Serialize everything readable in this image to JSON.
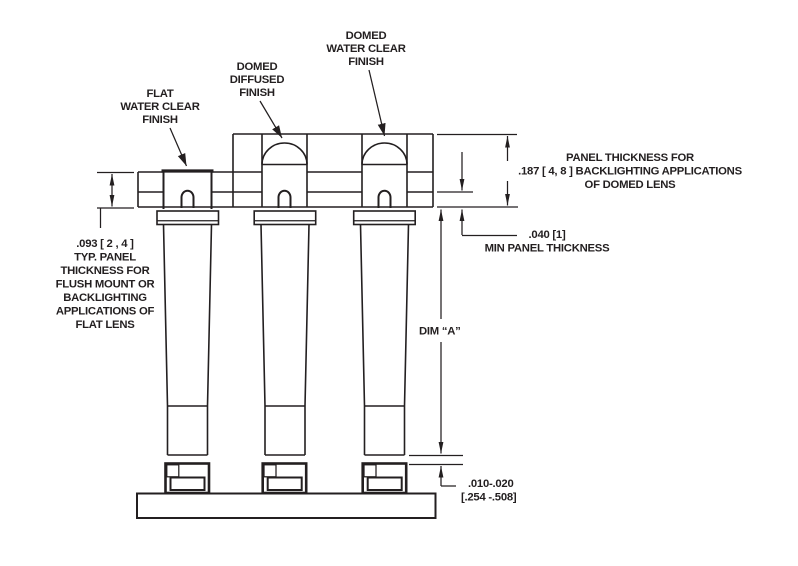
{
  "drawing_type": "panel-mount LED light pipe cross-section",
  "colors": {
    "ink": "#231f20",
    "paper": "#ffffff"
  },
  "callouts": {
    "flat": [
      "FLAT",
      "WATER CLEAR",
      "FINISH"
    ],
    "diffused": [
      "DOMED",
      "DIFFUSED",
      "FINISH"
    ],
    "domed_clear": [
      "DOMED",
      "WATER CLEAR",
      "FINISH"
    ]
  },
  "dimensions": {
    "flat_panel": [
      ".093 [ 2 , 4 ]",
      "TYP. PANEL",
      "THICKNESS FOR",
      "FLUSH MOUNT OR",
      "BACKLIGHTING",
      "APPLICATIONS OF",
      "FLAT LENS"
    ],
    "domed_panel": [
      "PANEL THICKNESS FOR",
      ".187 [ 4, 8 ] BACKLIGHTING APPLICATIONS",
      "OF DOMED LENS"
    ],
    "min_panel": [
      ".040 [1]",
      "MIN PANEL THICKNESS"
    ],
    "dim_a": "DIM “A”",
    "led_gap": [
      ".010-.020",
      "[.254 -.508]"
    ]
  }
}
